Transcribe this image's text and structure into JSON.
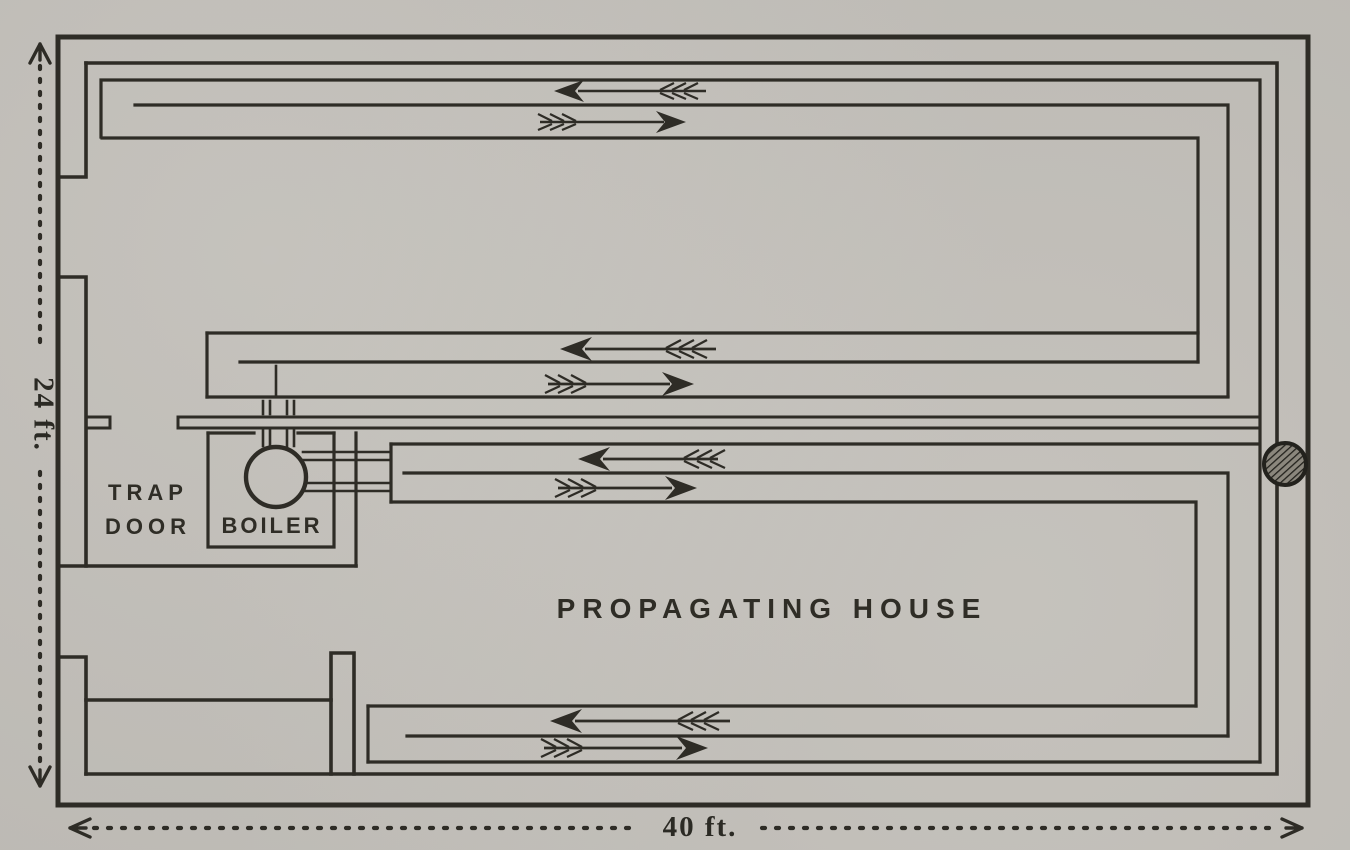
{
  "figure": {
    "kind": "engraved plan diagram of a greenhouse heating layout",
    "labels": {
      "house": "PROPAGATING HOUSE",
      "trap_door_line1": "TRAP",
      "trap_door_line2": "DOOR",
      "boiler": "BOILER"
    },
    "dimensions": {
      "height": "24 ft.",
      "width": "40 ft."
    },
    "colors": {
      "paper": "#c9c6c0",
      "ink": "#2e2c26"
    },
    "icons": [
      "boiler-circle-icon",
      "chimney-hatched-circle-icon",
      "flow-arrow-left-icon",
      "flow-arrow-right-icon",
      "dimension-arrow-icon"
    ],
    "pipe_runs": [
      {
        "name": "top pipe run",
        "upper_channel_flow": "left",
        "lower_channel_flow": "right"
      },
      {
        "name": "upper middle pipe run",
        "upper_channel_flow": "left",
        "lower_channel_flow": "right"
      },
      {
        "name": "lower middle pipe run",
        "upper_channel_flow": "left",
        "lower_channel_flow": "right"
      },
      {
        "name": "bottom pipe run",
        "upper_channel_flow": "left",
        "lower_channel_flow": "right"
      }
    ]
  }
}
